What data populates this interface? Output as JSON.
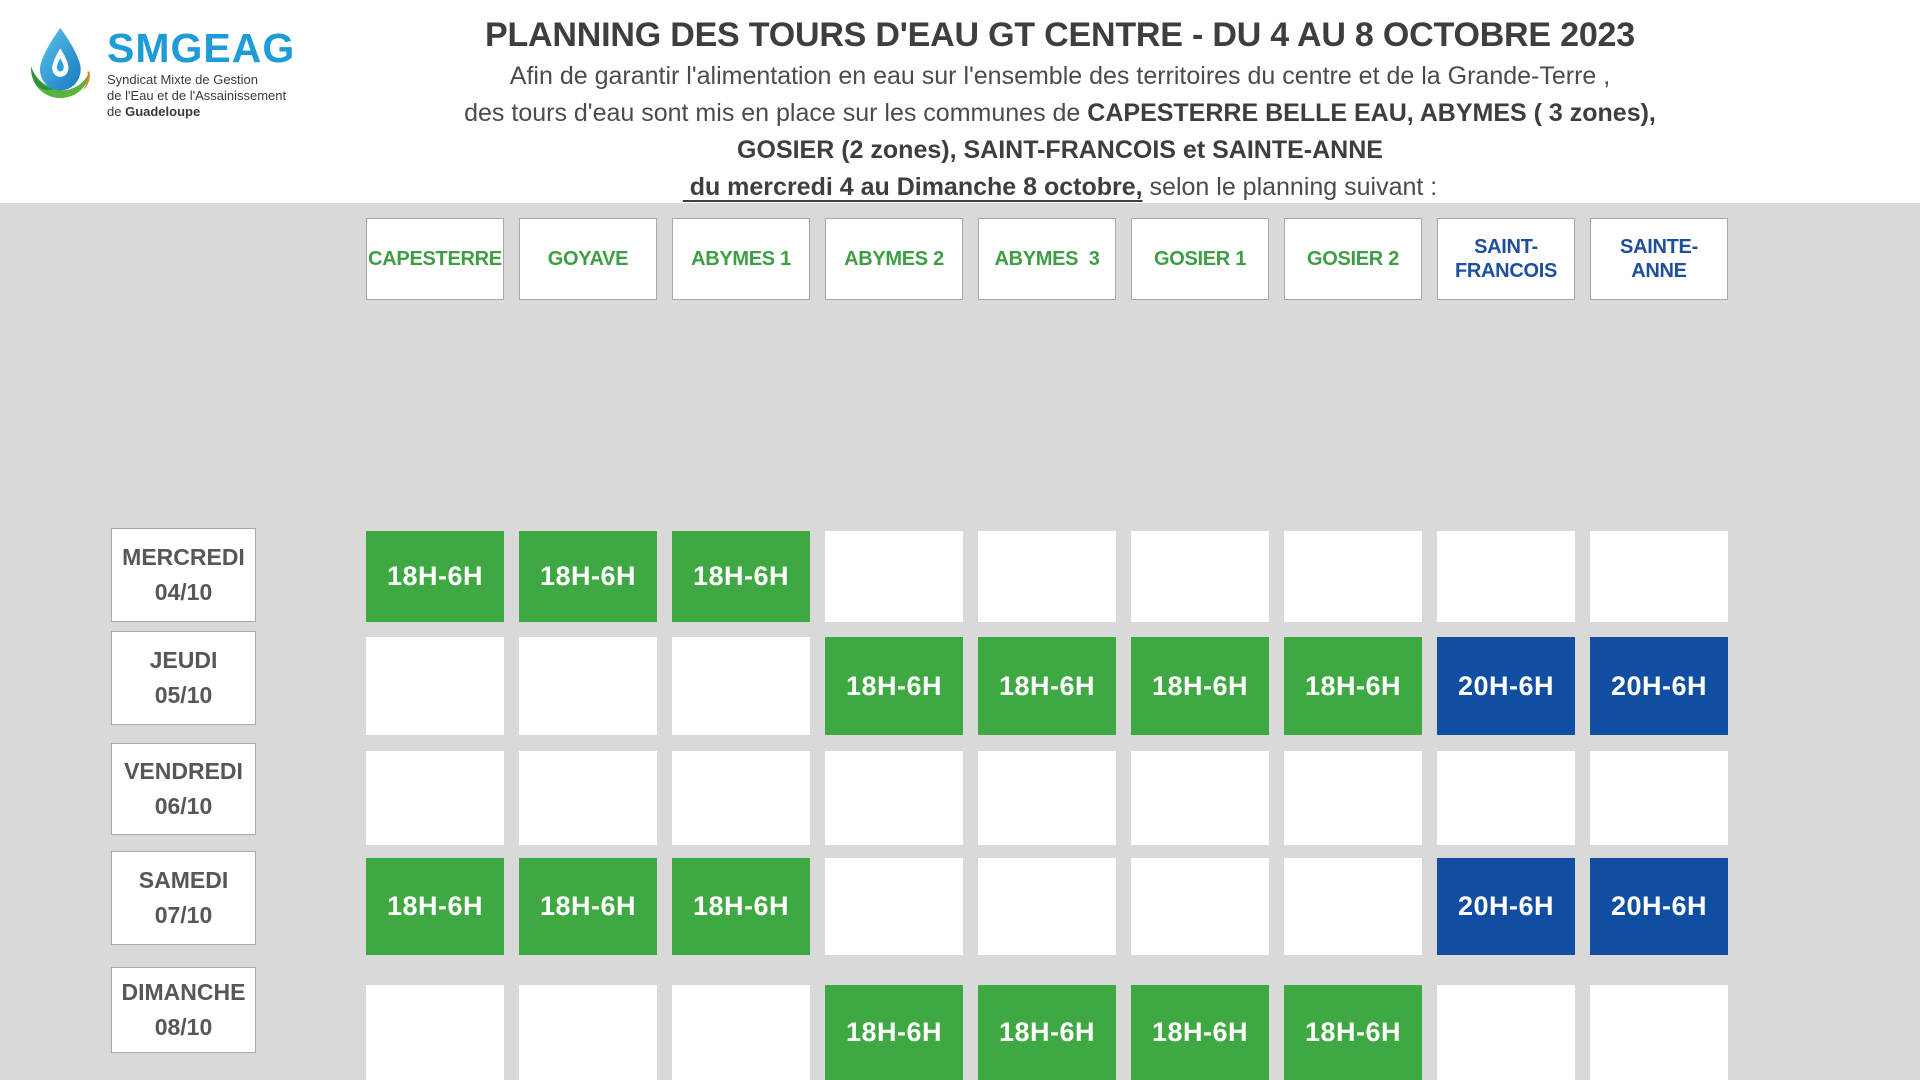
{
  "colors": {
    "background": "#D9D9D9",
    "band": "#FFFFFF",
    "green_fill": "#3EA843",
    "blue_fill": "#114DA1",
    "green_text": "#3F9E45",
    "blue_text": "#1C4F9C",
    "title_text": "#3E3E3E",
    "body_text": "#4B4B4B",
    "day_text": "#575757",
    "cell_text": "#FFFFFF",
    "box_border": "#A8A8A8",
    "logo_blue": "#1E9CD9"
  },
  "logo": {
    "name": "SMGEAG",
    "tagline_line1": "Syndicat Mixte de Gestion",
    "tagline_line2": "de l'Eau et de l'Assainissement",
    "tagline_line3_prefix": "de ",
    "tagline_line3_bold": "Guadeloupe"
  },
  "header": {
    "title": "PLANNING DES TOURS D'EAU GT CENTRE - DU 4 AU 8 OCTOBRE 2023",
    "intro_line1": "Afin de garantir l'alimentation en eau sur l'ensemble des territoires du centre et de la Grande-Terre ,",
    "intro_line2_prefix": "des tours d'eau sont mis en place sur les communes de ",
    "intro_line2_bold": "CAPESTERRE BELLE EAU, ABYMES ( 3 zones),",
    "intro_line3_bold": "GOSIER (2 zones), SAINT-FRANCOIS et SAINTE-ANNE",
    "intro_line4_underline": " du mercredi 4 au Dimanche 8 octobre,",
    "intro_line4_suffix": " selon le planning suivant :"
  },
  "schedule": {
    "columns": [
      {
        "label": "CAPESTERRE",
        "theme": "green"
      },
      {
        "label": "GOYAVE",
        "theme": "green"
      },
      {
        "label": "ABYMES 1",
        "theme": "green"
      },
      {
        "label": "ABYMES 2",
        "theme": "green"
      },
      {
        "label": "ABYMES  3",
        "theme": "green"
      },
      {
        "label": "GOSIER 1",
        "theme": "green"
      },
      {
        "label": "GOSIER 2",
        "theme": "green"
      },
      {
        "label": "SAINT-\nFRANCOIS",
        "theme": "blue"
      },
      {
        "label": "SAINTE-\nANNE",
        "theme": "blue"
      }
    ],
    "rows": [
      {
        "day": "MERCREDI",
        "date": "04/10"
      },
      {
        "day": "JEUDI",
        "date": "05/10"
      },
      {
        "day": "VENDREDI",
        "date": "06/10"
      },
      {
        "day": "SAMEDI",
        "date": "07/10"
      },
      {
        "day": "DIMANCHE",
        "date": "08/10"
      }
    ],
    "cells": [
      [
        "18H-6H",
        "18H-6H",
        "18H-6H",
        "",
        "",
        "",
        "",
        "",
        ""
      ],
      [
        "",
        "",
        "",
        "18H-6H",
        "18H-6H",
        "18H-6H",
        "18H-6H",
        "20H-6H",
        "20H-6H"
      ],
      [
        "",
        "",
        "",
        "",
        "",
        "",
        "",
        "",
        ""
      ],
      [
        "18H-6H",
        "18H-6H",
        "18H-6H",
        "",
        "",
        "",
        "",
        "20H-6H",
        "20H-6H"
      ],
      [
        "",
        "",
        "",
        "18H-6H",
        "18H-6H",
        "18H-6H",
        "18H-6H",
        "",
        ""
      ]
    ],
    "green_slot_label": "18H-6H",
    "blue_slot_label": "20H-6H"
  }
}
